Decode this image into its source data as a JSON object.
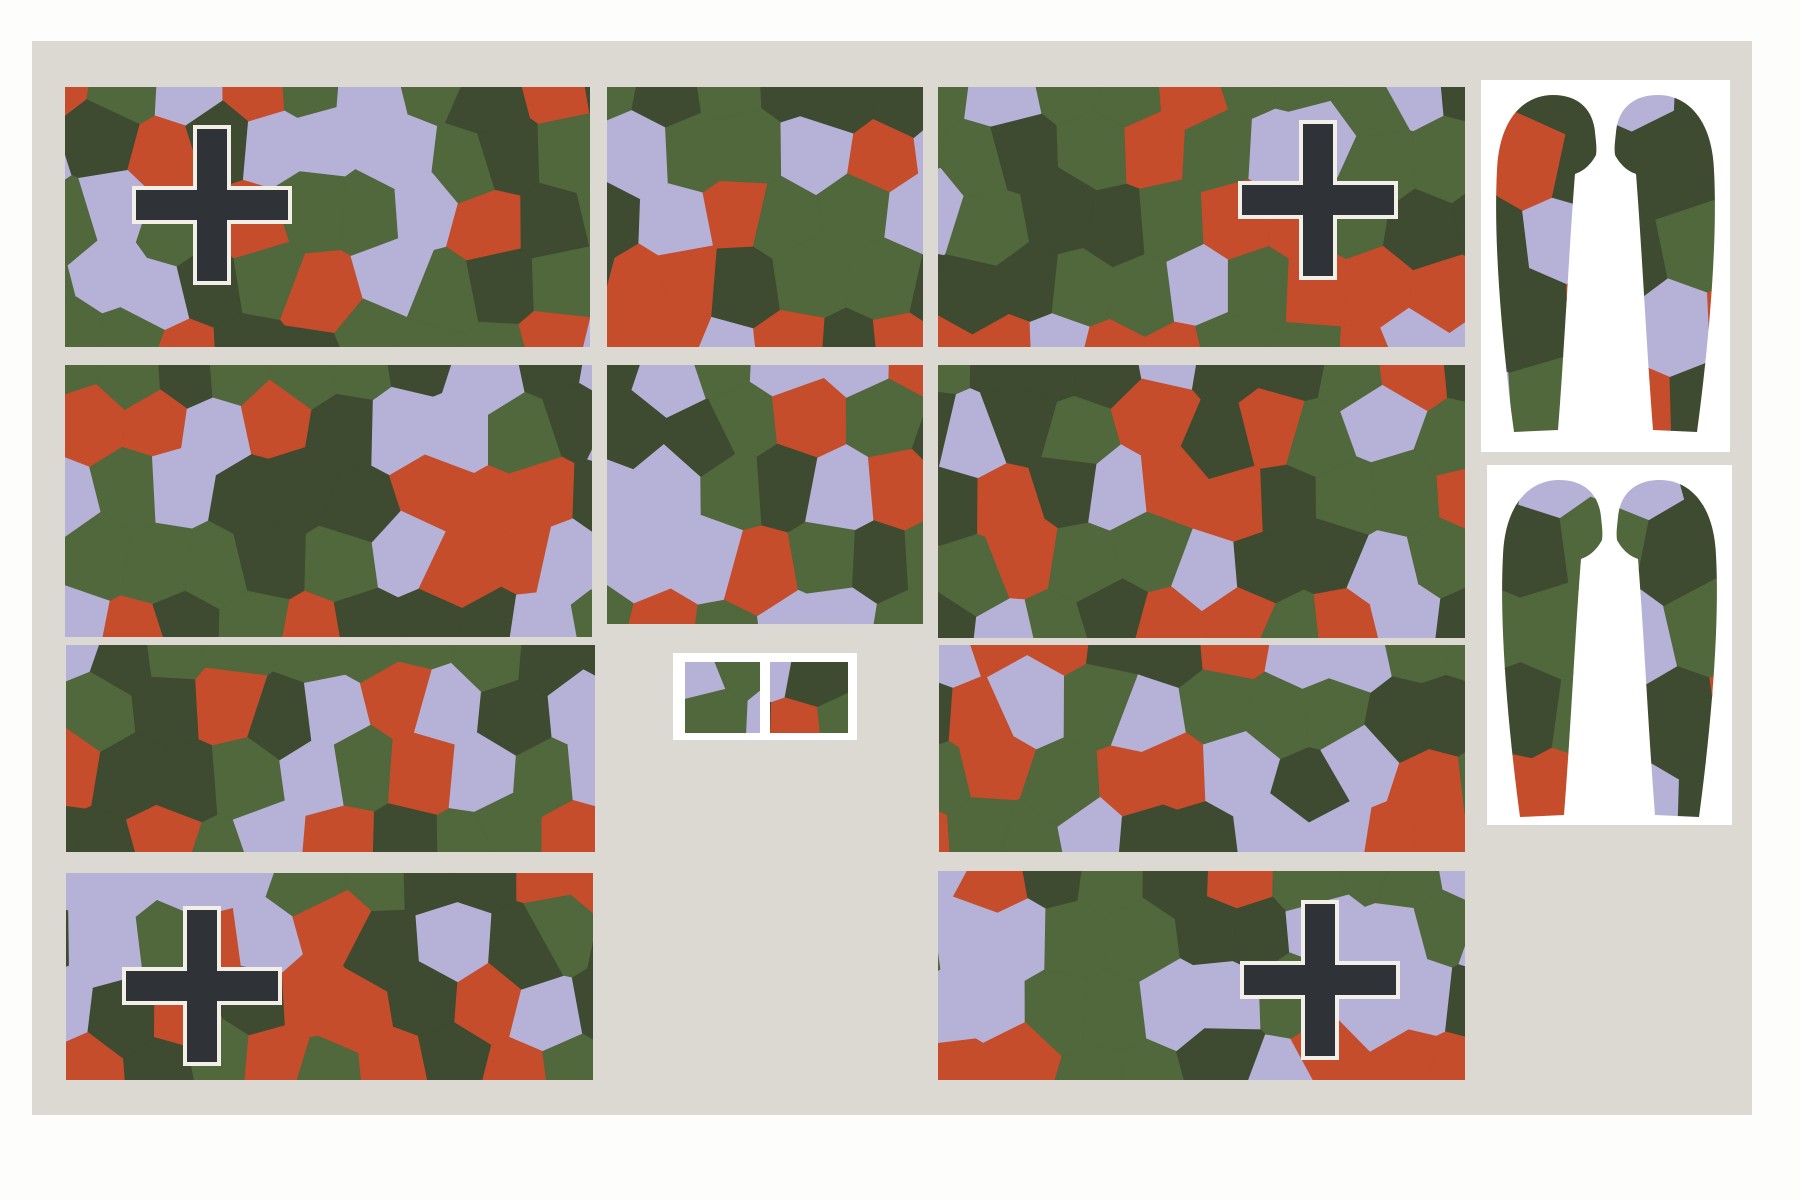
{
  "sheet": {
    "description": "printable camouflage pattern piece sheet",
    "page_bg": "#fdfdfb",
    "board_bg": "#dcd9d2",
    "panel_white": "#ffffff",
    "palette": {
      "olive": "#51673c",
      "dark_green": "#3e4b30",
      "rust": "#c54d2b",
      "lavender": "#b6b2d7"
    },
    "color_weights": {
      "olive": 0.28,
      "dark_green": 0.27,
      "rust": 0.23,
      "lavender": 0.22
    },
    "cross_marking": {
      "fill": "#2f3237",
      "outline": "#f1efe7",
      "size": 152,
      "arm_thickness": 30,
      "outline_width": 4
    },
    "board": {
      "x": 32,
      "y": 41,
      "w": 1720,
      "h": 1074
    },
    "camo_cell": {
      "dx": 60,
      "dy": 66,
      "jitter": 15
    },
    "leg_cell": {
      "dx": 76,
      "dy": 82,
      "jitter": 16
    },
    "panels": [
      {
        "id": "camo-panel-row1-left",
        "x": 65,
        "y": 87,
        "w": 525,
        "h": 260,
        "seed": 11,
        "cross": {
          "cx": 147,
          "cy": 118
        }
      },
      {
        "id": "camo-panel-row1-mid",
        "x": 607,
        "y": 87,
        "w": 316,
        "h": 260,
        "seed": 22,
        "cross": null
      },
      {
        "id": "camo-panel-row1-right",
        "x": 938,
        "y": 87,
        "w": 527,
        "h": 260,
        "seed": 33,
        "cross": {
          "cx": 380,
          "cy": 113
        }
      },
      {
        "id": "camo-panel-row2-left",
        "x": 65,
        "y": 365,
        "w": 527,
        "h": 272,
        "seed": 44,
        "cross": null
      },
      {
        "id": "camo-panel-row2-mid",
        "x": 607,
        "y": 365,
        "w": 316,
        "h": 259,
        "seed": 55,
        "cross": null
      },
      {
        "id": "camo-panel-row2-right",
        "x": 938,
        "y": 365,
        "w": 527,
        "h": 273,
        "seed": 66,
        "cross": null
      },
      {
        "id": "camo-panel-row3-left",
        "x": 66,
        "y": 645,
        "w": 529,
        "h": 207,
        "seed": 77,
        "cross": null
      },
      {
        "id": "camo-panel-row3-right",
        "x": 939,
        "y": 645,
        "w": 526,
        "h": 207,
        "seed": 88,
        "cross": null
      },
      {
        "id": "camo-panel-row4-left",
        "x": 66,
        "y": 873,
        "w": 527,
        "h": 207,
        "seed": 99,
        "cross": {
          "cx": 136,
          "cy": 113
        }
      },
      {
        "id": "camo-panel-row4-right",
        "x": 938,
        "y": 871,
        "w": 527,
        "h": 209,
        "seed": 111,
        "cross": {
          "cx": 382,
          "cy": 109
        }
      }
    ],
    "small_piece": {
      "x": 673,
      "y": 653,
      "w": 184,
      "h": 87,
      "squares": [
        {
          "x": 12,
          "y": 9,
          "w": 75,
          "h": 71,
          "seed": 121
        },
        {
          "x": 97,
          "y": 9,
          "w": 78,
          "h": 71,
          "seed": 131
        }
      ]
    },
    "cutout_sheets": [
      {
        "id": "gear-fairing-sheet-top",
        "x": 1481,
        "y": 80,
        "w": 249,
        "h": 372,
        "seed": 141
      },
      {
        "id": "gear-fairing-sheet-bottom",
        "x": 1487,
        "y": 465,
        "w": 245,
        "h": 360,
        "seed": 151
      }
    ]
  }
}
